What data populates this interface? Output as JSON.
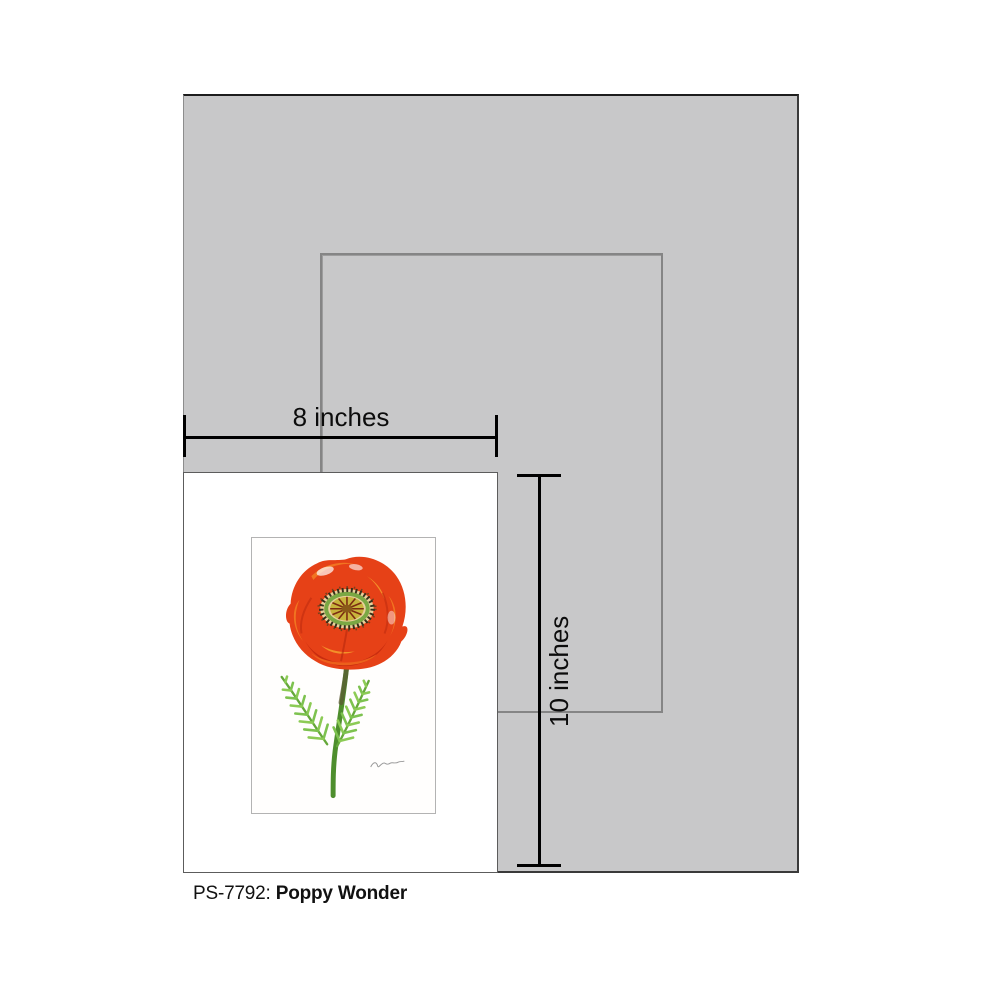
{
  "caption": {
    "code": "PS-7792:",
    "name": "Poppy Wonder"
  },
  "dimensions": {
    "width_label": "8 inches",
    "height_label": "10 inches"
  },
  "artwork": {
    "subject": "red poppy flower with fern leaves",
    "icon": "poppy-flower-illustration"
  },
  "colors": {
    "page_background": "#ffffff",
    "mat_gray": "#c8c8c9",
    "frame_opening_outline": "#858585",
    "print_card_white": "#ffffff",
    "dimension_line_black": "#000000",
    "poppy_red": "#e64117",
    "poppy_orange": "#f27a22",
    "poppy_highlight": "#f6a42e",
    "flower_center_olive": "#c8b43c",
    "leaf_green": "#7dc24f",
    "stem_green": "#4e8e2d"
  }
}
